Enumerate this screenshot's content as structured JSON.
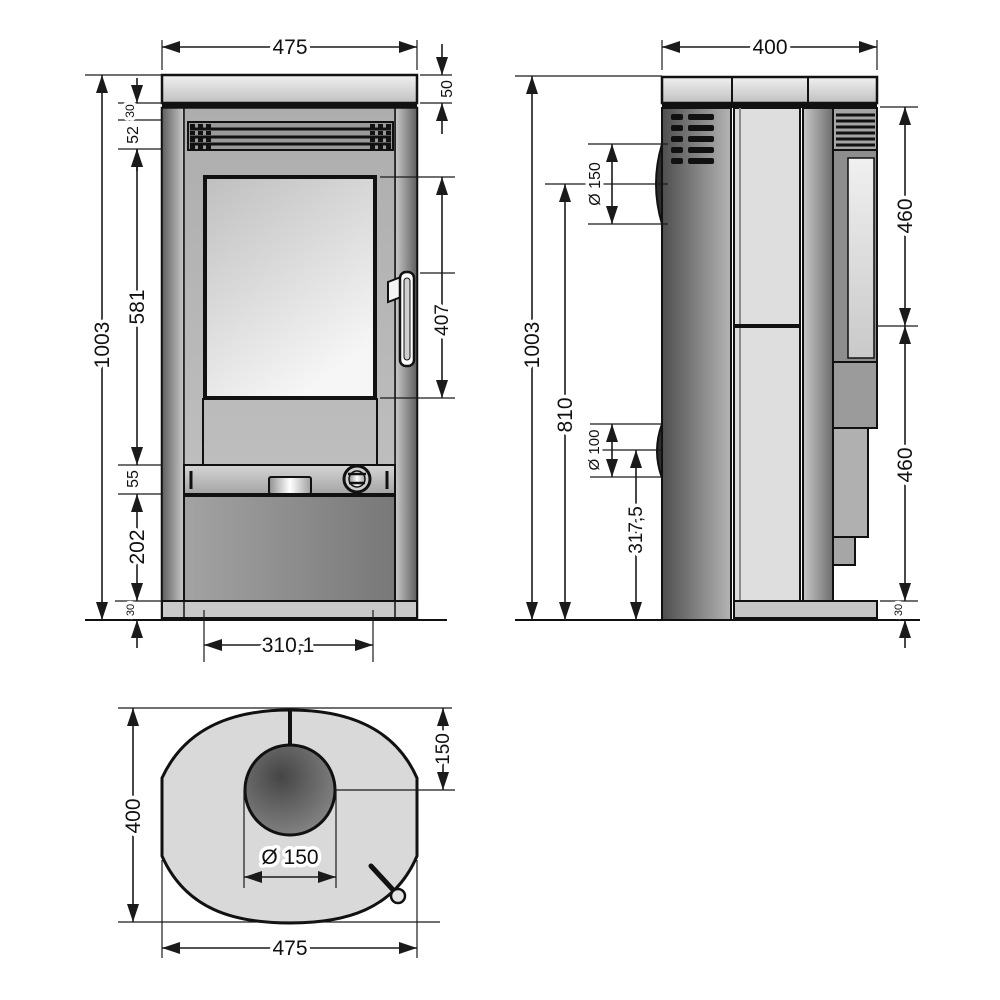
{
  "drawing": {
    "title": "stove-technical-dimension-drawing",
    "front_view": {
      "width_total": "475",
      "plate_thickness": "50",
      "gap_below_plate": "30",
      "vent_height": "52",
      "body_upper_height": "581",
      "height_total": "1003",
      "glass_height": "407",
      "control_band_height": "55",
      "ash_door_height": "202",
      "plinth_height": "30",
      "door_width": "310,1"
    },
    "side_view": {
      "depth_total": "400",
      "height_total": "1003",
      "flue_center_height": "810",
      "flue_diameter": "Ø 150",
      "rear_outlet_diameter": "Ø 100",
      "rear_outlet_center_height": "317,5",
      "panel_upper_height": "460",
      "panel_lower_height": "460",
      "plinth_height": "30"
    },
    "top_view": {
      "depth_total": "400",
      "flue_center_offset": "150",
      "flue_diameter": "Ø 150",
      "width_total": "475"
    },
    "colors": {
      "line": "#1a1a1a",
      "body_light": "#dedede",
      "body_mid": "#a8a8a8",
      "body_dark": "#5f5f5f",
      "background": "#ffffff"
    }
  }
}
